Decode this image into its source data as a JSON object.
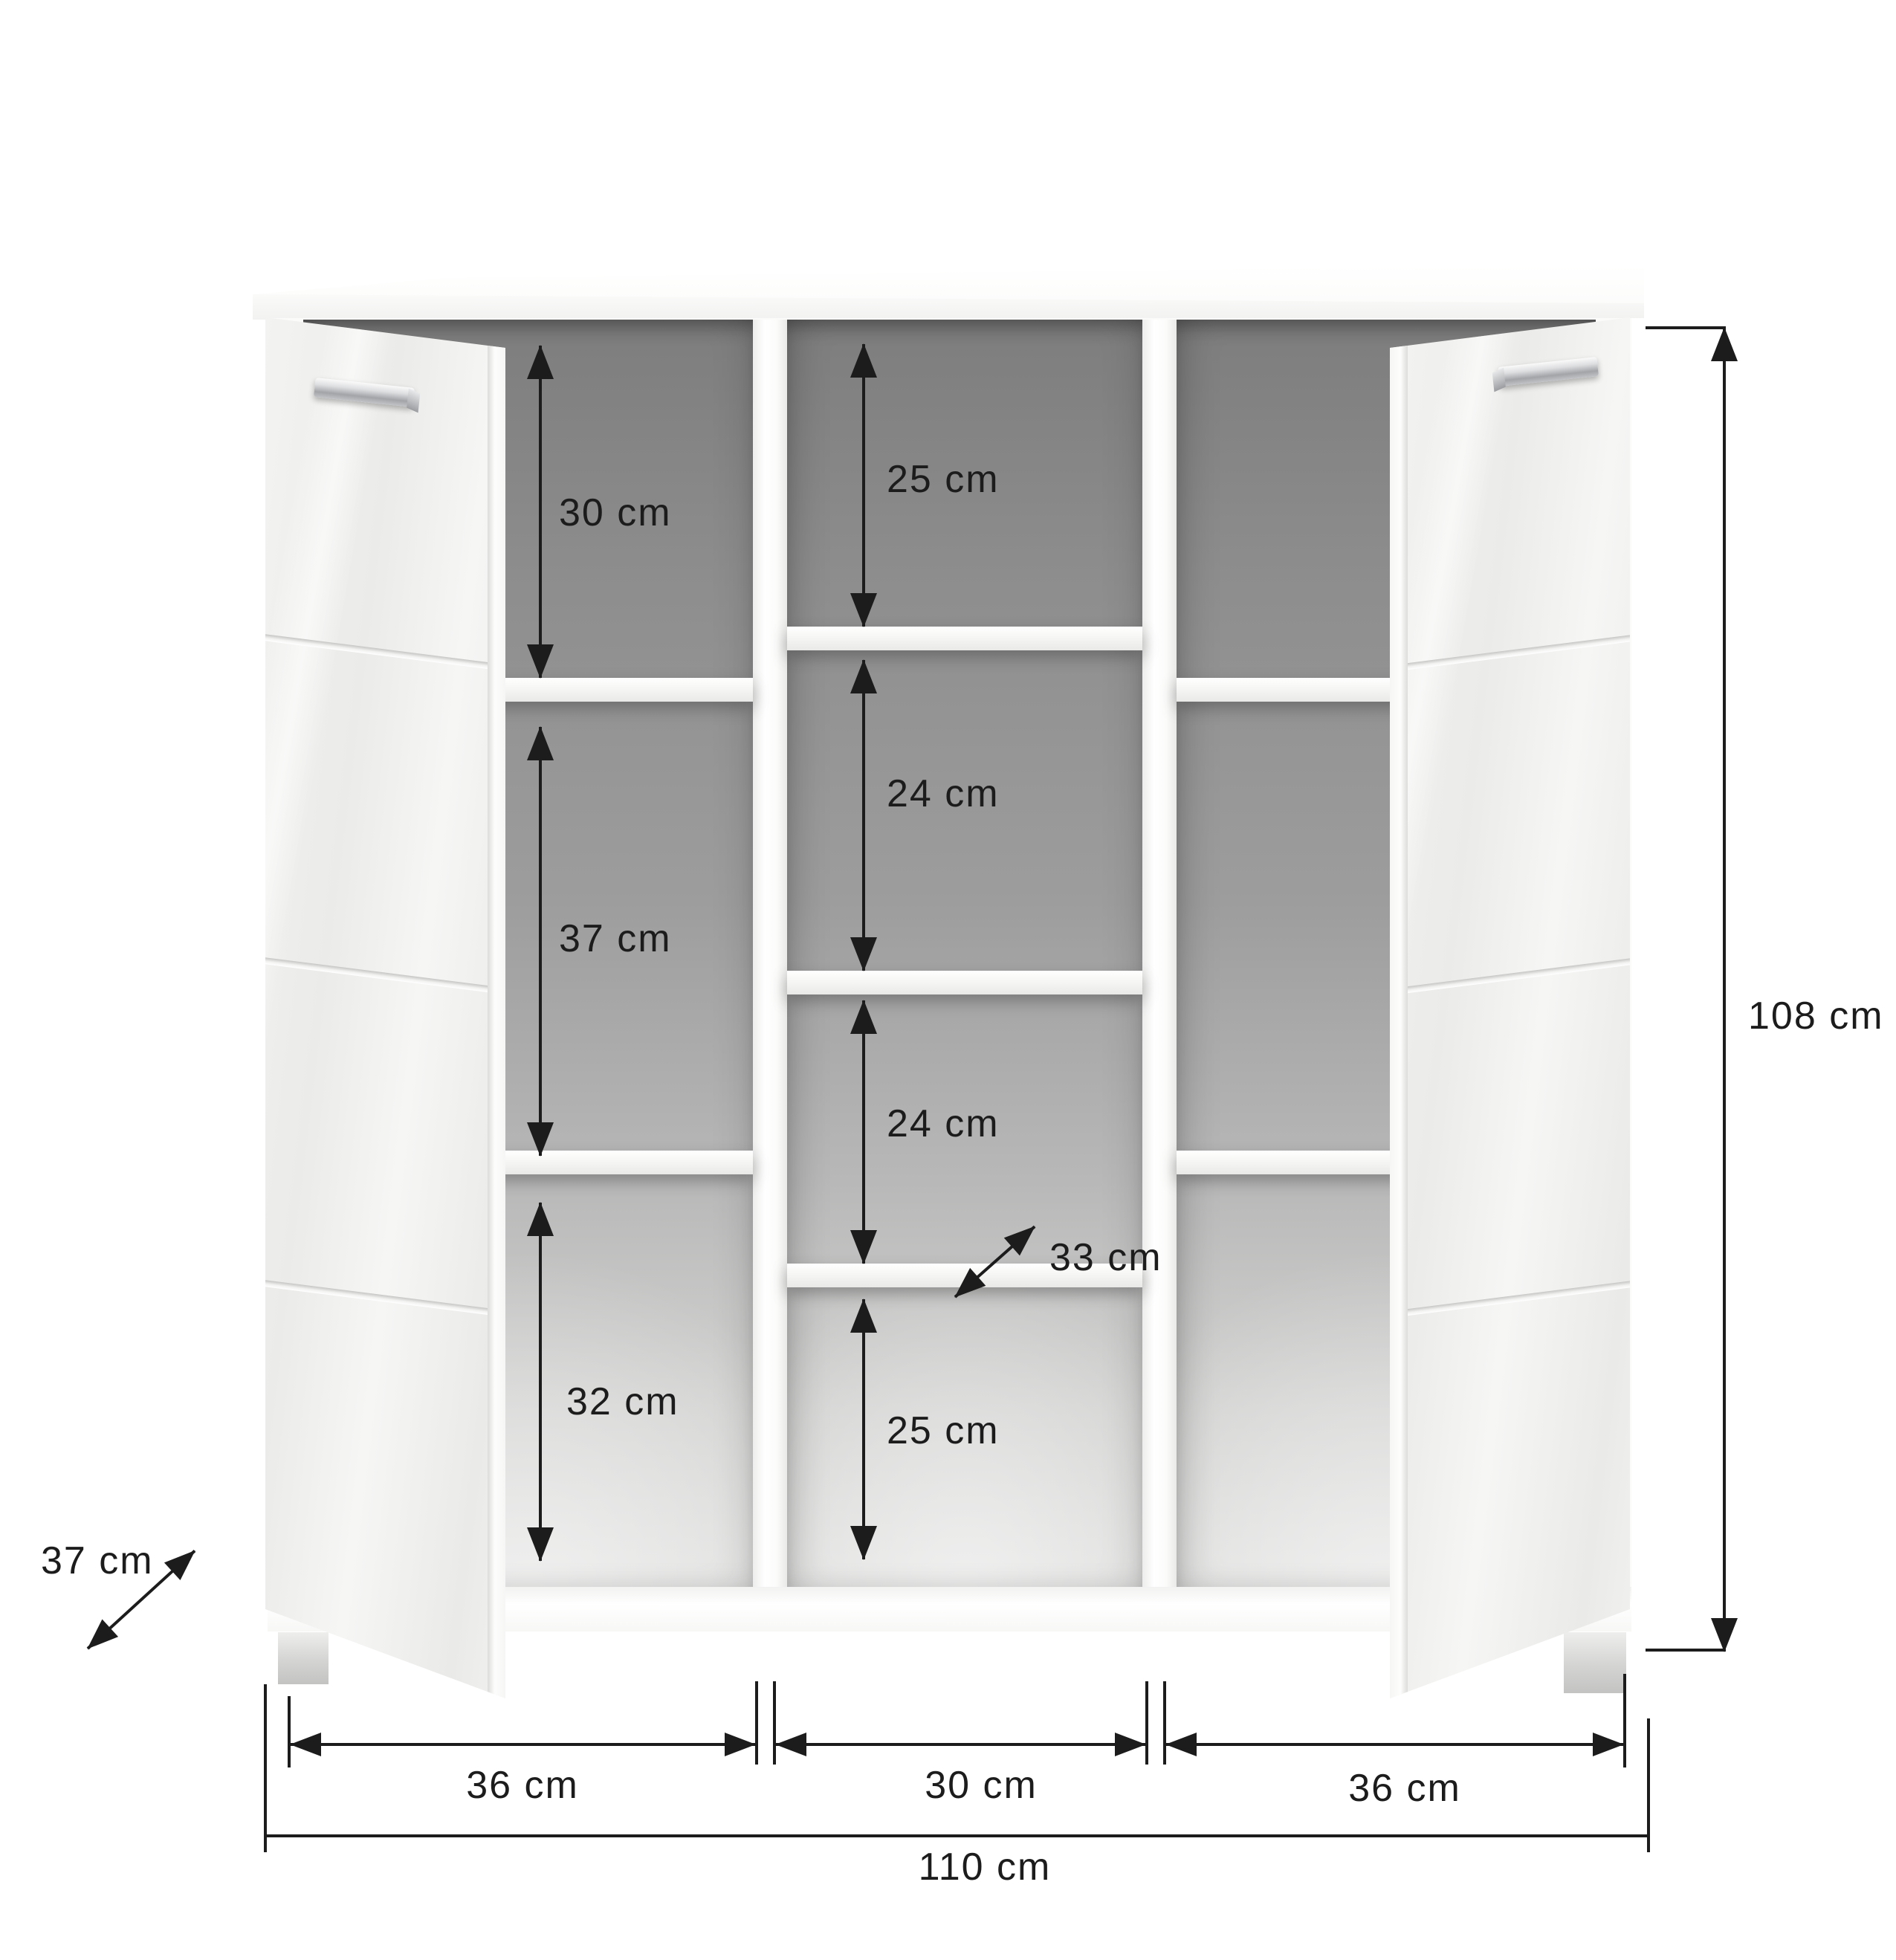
{
  "labels": {
    "left_top": "30 cm",
    "left_middle": "37 cm",
    "left_bottom": "32 cm",
    "middle_1": "25 cm",
    "middle_2": "24 cm",
    "middle_3": "24 cm",
    "middle_4": "25 cm",
    "shelf_depth": "33 cm",
    "cabinet_depth": "37 cm",
    "cabinet_height": "108 cm",
    "width_left": "36 cm",
    "width_middle": "30 cm",
    "width_right": "36 cm",
    "width_total": "110 cm"
  },
  "colors": {
    "background": "#ffffff",
    "annotation": "#1c1c1c",
    "cabinet_white": "#f6f6f5",
    "interior_gray": "#9a9a9a",
    "chrome_handle": "#b9babc"
  }
}
